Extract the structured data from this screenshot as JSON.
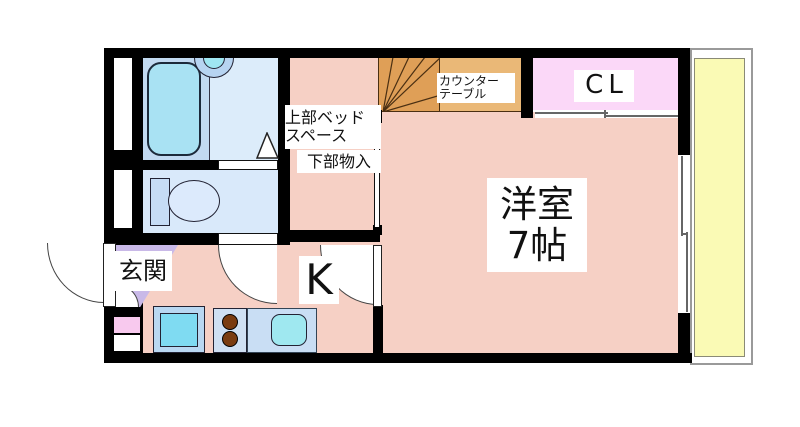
{
  "plan_title": "1K apartment floor plan",
  "rooms": {
    "main": {
      "line1": "洋室",
      "line2": "7帖"
    },
    "closet": {
      "label": "CL"
    },
    "kitchen": {
      "label": "K"
    },
    "entrance": {
      "label": "玄関"
    },
    "bed_space": {
      "line1": "上部ベッド",
      "line2": "スペース"
    },
    "storage": {
      "label": "下部物入"
    },
    "counter_table": {
      "line1": "カウンター",
      "line2": "テーブル"
    }
  },
  "fixtures": [
    "bathtub",
    "wash-basin",
    "toilet",
    "washing-machine",
    "stove-2-burner",
    "kitchen-sink",
    "loft-stairs",
    "entrance-door",
    "toilet-door",
    "bathroom-folding-door",
    "room-door",
    "closet-sliding-door",
    "balcony-window"
  ],
  "colors": {
    "wall": "#000000",
    "floor_pink": "#f6d0c5",
    "closet_pink": "#fbd8f8",
    "entrance_lavender": "#c9b9e8",
    "bathroom_blue": "#dcecfa",
    "toilet_blue": "#d9e9fa",
    "bathtub_cyan": "#a9e2f3",
    "washer_cyan": "#7fdbf2",
    "sink_cyan": "#9fe8f0",
    "stairs_orange": "#df9f57",
    "counter_orange": "#eab877",
    "balcony_yellow": "#fafab5",
    "meter_panel_pink": "#f8c9ee"
  }
}
